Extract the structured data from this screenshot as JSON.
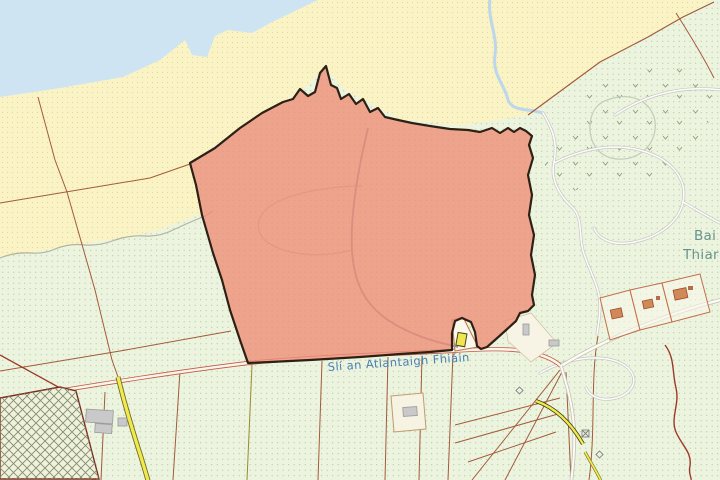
{
  "map": {
    "road_label": "Slí an Atlantaigh Fhiáin",
    "place_label": {
      "line1": "Bai",
      "line2": "Thiar"
    }
  },
  "colors": {
    "sea": "#cfe4f3",
    "sand": "#f9f3c5",
    "field": "#ecf4e0",
    "parcel_fill": "#ee8c76",
    "parcel_outline": "#2d2014",
    "main_road_casing": "#bf5a45",
    "minor_boundary": "#a35a3a",
    "yellow_road": "#f2e94f",
    "stream": "#bcd7ec",
    "road_label_text": "#4a7fb3",
    "place_label_text": "#66948a"
  }
}
